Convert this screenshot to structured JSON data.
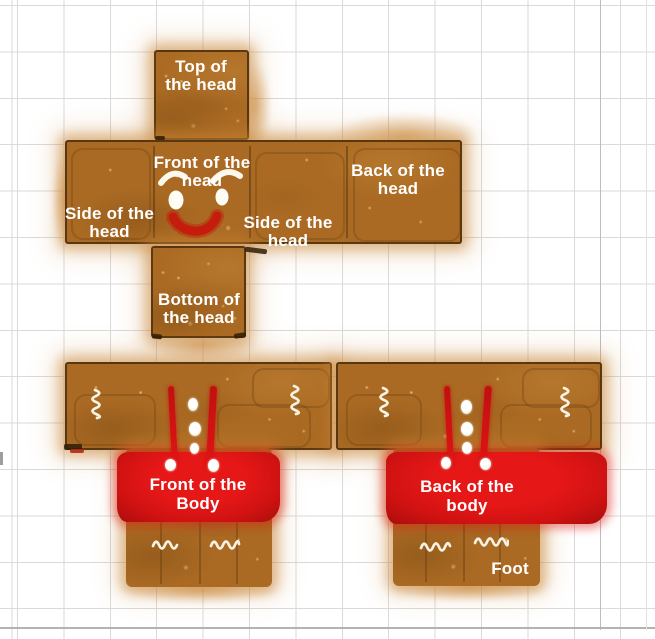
{
  "title": "Gingerbread character papercraft texture template",
  "palette": {
    "gingerbread_brown": "#aa6a23",
    "gingerbread_dark": "#7d521a",
    "gingerbread_light": "#c78a3c",
    "icing_red": "#d21212",
    "icing_white": "#ffffff",
    "grid_line": "#dadada",
    "background": "#ffffff"
  },
  "head": {
    "top": {
      "line1": "Top of",
      "line2": "the head"
    },
    "front": {
      "line1": "Front of the",
      "line2": "head"
    },
    "back": {
      "label": "Back of the head"
    },
    "side_left": {
      "line1": "Side of the",
      "line2": "head"
    },
    "side_right": {
      "line1": "Side of the",
      "line2": "head"
    },
    "bottom": {
      "line1": "Bottom of",
      "line2": "the head"
    }
  },
  "body": {
    "front": {
      "line1": "Front of the",
      "line2": "Body"
    },
    "back": {
      "line1": "Back of the",
      "line2": "body"
    },
    "foot_label": "Foot"
  }
}
